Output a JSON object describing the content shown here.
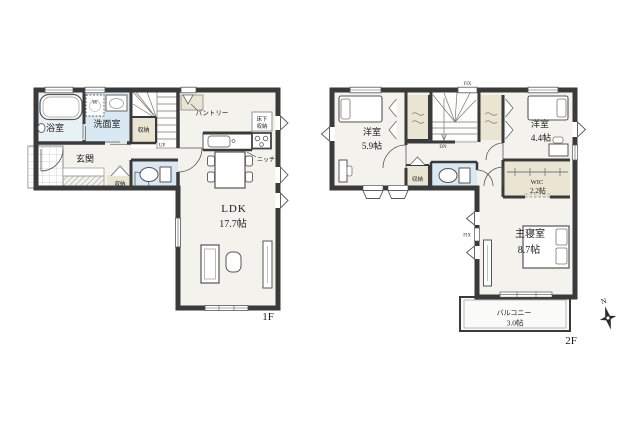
{
  "floor1": {
    "floor_label": "1F",
    "bath": "浴室",
    "washroom": "洗面室",
    "washer_symbol": "W",
    "stair_closet": "収納",
    "entrance": "玄関",
    "entrance_closet": "収納",
    "stairs_direction": "UP",
    "pantry": "パントリー",
    "underfloor_storage_line1": "床下",
    "underfloor_storage_line2": "収納",
    "niche": "ニッチ",
    "ldk_name": "LDK",
    "ldk_size": "17.7帖"
  },
  "floor2": {
    "floor_label": "2F",
    "bedroom1_name": "洋室",
    "bedroom1_size": "5.9帖",
    "bedroom2_name": "洋室",
    "bedroom2_size": "4.4帖",
    "hall_closet": "収納",
    "wic_name": "WIC",
    "wic_size": "2.2帖",
    "master_name": "主寝室",
    "master_size": "8.7帖",
    "balcony_name": "バルコニー",
    "balcony_size": "3.0帖",
    "stairs_direction": "DN",
    "fix_window_top": "FIX",
    "fix_window_left": "FIX"
  },
  "compass": {
    "north": "N"
  },
  "colors": {
    "wall": "#3a3a3a",
    "floor": "#f4f2ec",
    "wet_floor": "#d9e8f2",
    "bath_floor": "#e8f1f6",
    "closet_floor": "#eae4d3",
    "line": "#555555"
  }
}
